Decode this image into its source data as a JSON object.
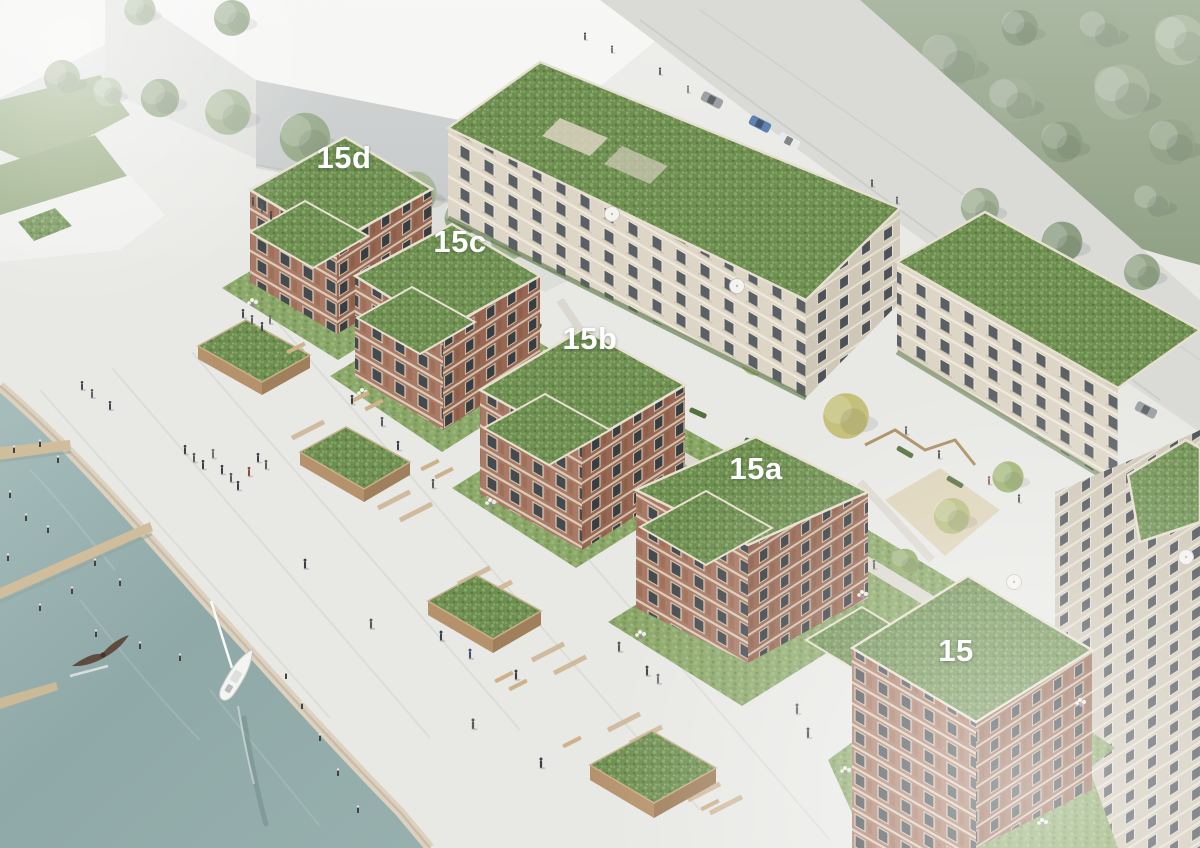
{
  "scene": {
    "title": "Aerial architectural rendering of a waterfront residential quarter",
    "type": "architectural-rendering",
    "description": "Bird's-eye visualization of green-roofed brick apartment buildings (addresses 15, 15a, 15b, 15c, 15d) along a harbor promenade with water, wooden jetties, a sailboat, a flying bird, planters, pedestrians, a rear courtyard with playground, and surrounding white massing buildings and trees."
  },
  "buildings": [
    {
      "id": "15d",
      "label": "15d"
    },
    {
      "id": "15c",
      "label": "15c"
    },
    {
      "id": "15b",
      "label": "15b"
    },
    {
      "id": "15a",
      "label": "15a"
    },
    {
      "id": "15",
      "label": "15"
    }
  ],
  "elements": [
    "water",
    "quay-edge",
    "jetties",
    "mooring-posts",
    "sailboat",
    "flying-bird",
    "promenade",
    "wooden-planters",
    "benches",
    "pedestrians",
    "courtyard-lawn",
    "playground",
    "parasols",
    "flower-beds",
    "hedges",
    "street-trees",
    "forest",
    "cars",
    "white-massing-buildings",
    "green-roofs"
  ],
  "colors": {
    "water": "#97b1b0",
    "pavement": "#e8e9e5",
    "lawn": "#88a565",
    "green_roof": "#6d8d51",
    "brick": "#a97a66",
    "cream_facade": "#ddd6c7",
    "wood_planter": "#b5926c",
    "forest": "#8fa084",
    "label_text": "#ffffff"
  }
}
